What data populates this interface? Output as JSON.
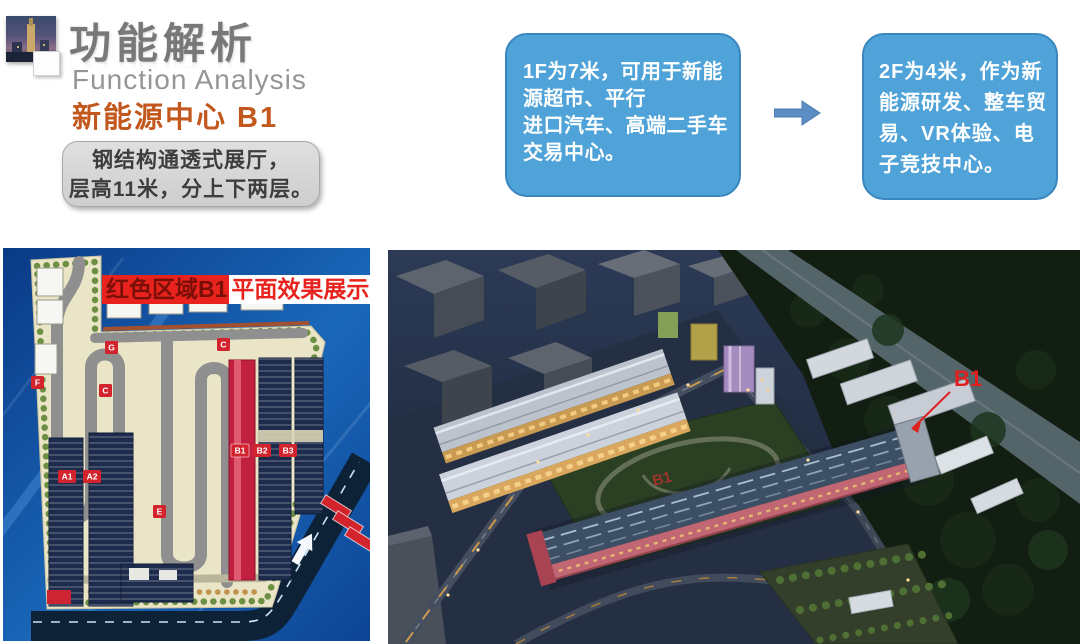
{
  "header": {
    "title_cn": "功能解析",
    "title_en": "Function Analysis",
    "subtitle": "新能源中心 B1"
  },
  "note_box": {
    "line1": "钢结构通透式展厅，",
    "line2": "层高11米，分上下两层。"
  },
  "floor1_box": {
    "line1": "1F为7米，可用于新能",
    "line2": "源超市、平行",
    "line3": "进口汽车、高端二手车",
    "line4": "交易中心。"
  },
  "floor2_box": {
    "line1": "2F为4米，作为新",
    "line2": "能源研发、整车贸",
    "line3": "易、VR体验、电",
    "line4": "子竞技中心。"
  },
  "site_plan": {
    "banner_red_part": "红色区域B1",
    "banner_white_part": "平面效果展示",
    "labels": {
      "f": "F",
      "g": "G",
      "c1": "C",
      "c2": "C",
      "e": "E",
      "a1": "A1",
      "a2": "A2",
      "b1": "B1",
      "b2": "B2",
      "b3": "B3"
    }
  },
  "render": {
    "b1_callout": "B1",
    "b1_roof_label": "B1"
  },
  "colors": {
    "callout_box_blue": "#4fa3d8",
    "subtitle_orange": "#c2581d",
    "banner_red": "#e8231d",
    "b1_highlight_red": "#c22040",
    "title_gray": "#787878",
    "plan_background_blue": "#0b3f8e",
    "night_render_navy": "#1a2333"
  }
}
